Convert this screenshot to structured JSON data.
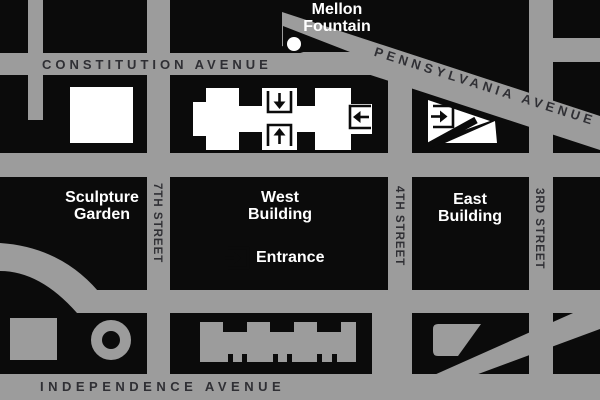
{
  "colors": {
    "street_gray": "#9c9c9c",
    "block_black": "#0b0b0b",
    "building_white": "#ffffff",
    "street_label_dark": "#2f2f34",
    "place_label_white": "#ffffff"
  },
  "streets": {
    "constitution": "CONSTITUTION AVENUE",
    "pennsylvania": "PENNSYLVANIA AVENUE",
    "independence": "INDEPENDENCE AVENUE",
    "seventh": "7TH STREET",
    "fourth": "4TH STREET",
    "third": "3RD STREET"
  },
  "places": {
    "mellon_fountain": "Mellon Fountain",
    "sculpture_garden": "Sculpture Garden",
    "west_building": "West Building",
    "east_building": "East Building"
  },
  "legend": {
    "entrance": "Entrance"
  },
  "icons": {
    "entrance_marker": "boxed-arrow (arrow entering an open bracket)",
    "fountain_marker": "white-dot"
  }
}
